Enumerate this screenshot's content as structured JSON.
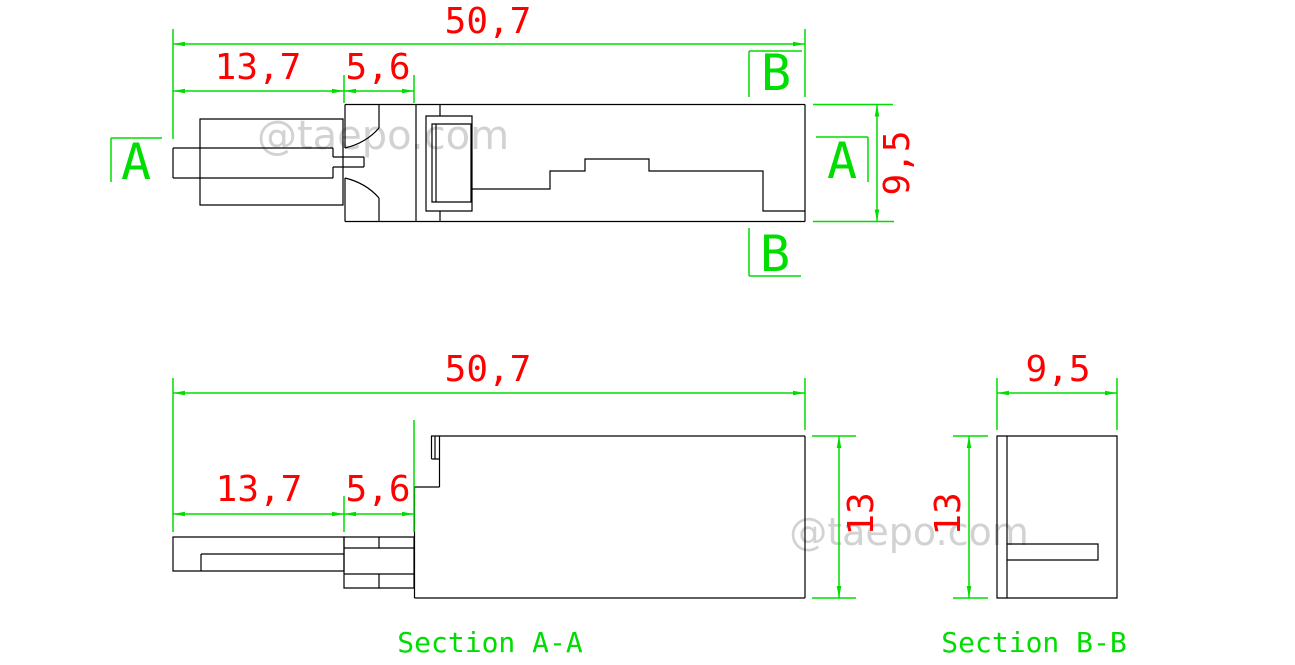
{
  "watermark": {
    "text": "@taepo.com"
  },
  "colors": {
    "outline": "#000000",
    "dimension_lines": "#00dd00",
    "dimension_text": "#ff0000",
    "section_labels": "#00dd00",
    "watermark": "#d2d2d2"
  },
  "top_view": {
    "dim_total_width": "50,7",
    "dim_plug_length": "13,7",
    "dim_mid_length": "5,6",
    "dim_height": "9,5",
    "marker_a_left": "A",
    "marker_a_right": "A",
    "marker_b_top": "B",
    "marker_b_bottom": "B"
  },
  "section_aa": {
    "title": "Section A-A",
    "dim_total_width": "50,7",
    "dim_plug_length": "13,7",
    "dim_mid_length": "5,6",
    "dim_height": "13"
  },
  "section_bb": {
    "title": "Section B-B",
    "dim_width": "9,5",
    "dim_height": "13"
  }
}
